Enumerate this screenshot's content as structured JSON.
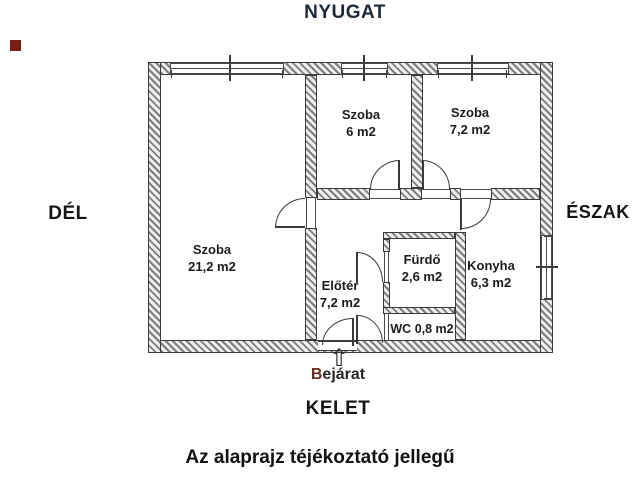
{
  "compass": {
    "west": "NYUGAT",
    "south": "DÉL",
    "north": "ÉSZAK",
    "east": "KELET"
  },
  "entrance": {
    "label": "Bejárat",
    "arrow_icon": "⇧"
  },
  "caption": "Az alaprajz téjékoztató jellegű",
  "rooms": [
    {
      "name": "Szoba",
      "area": "21,2 m2"
    },
    {
      "name": "Szoba",
      "area": "6 m2"
    },
    {
      "name": "Szoba",
      "area": "7,2 m2"
    },
    {
      "name": "Előtér",
      "area": "7,2 m2"
    },
    {
      "name": "Fürdő",
      "area": "2,6 m2"
    },
    {
      "name": "WC",
      "area": "0,8 m2"
    },
    {
      "name": "Konyha",
      "area": "6,3 m2"
    }
  ],
  "colors": {
    "wall_hatch": "#7d7d7d",
    "line": "#3a3a3a",
    "text": "#1c1c1c",
    "compass_west": "#1e2a3a",
    "entrance_initial": "#6d2c22",
    "corner_marker": "#7a1f16"
  }
}
